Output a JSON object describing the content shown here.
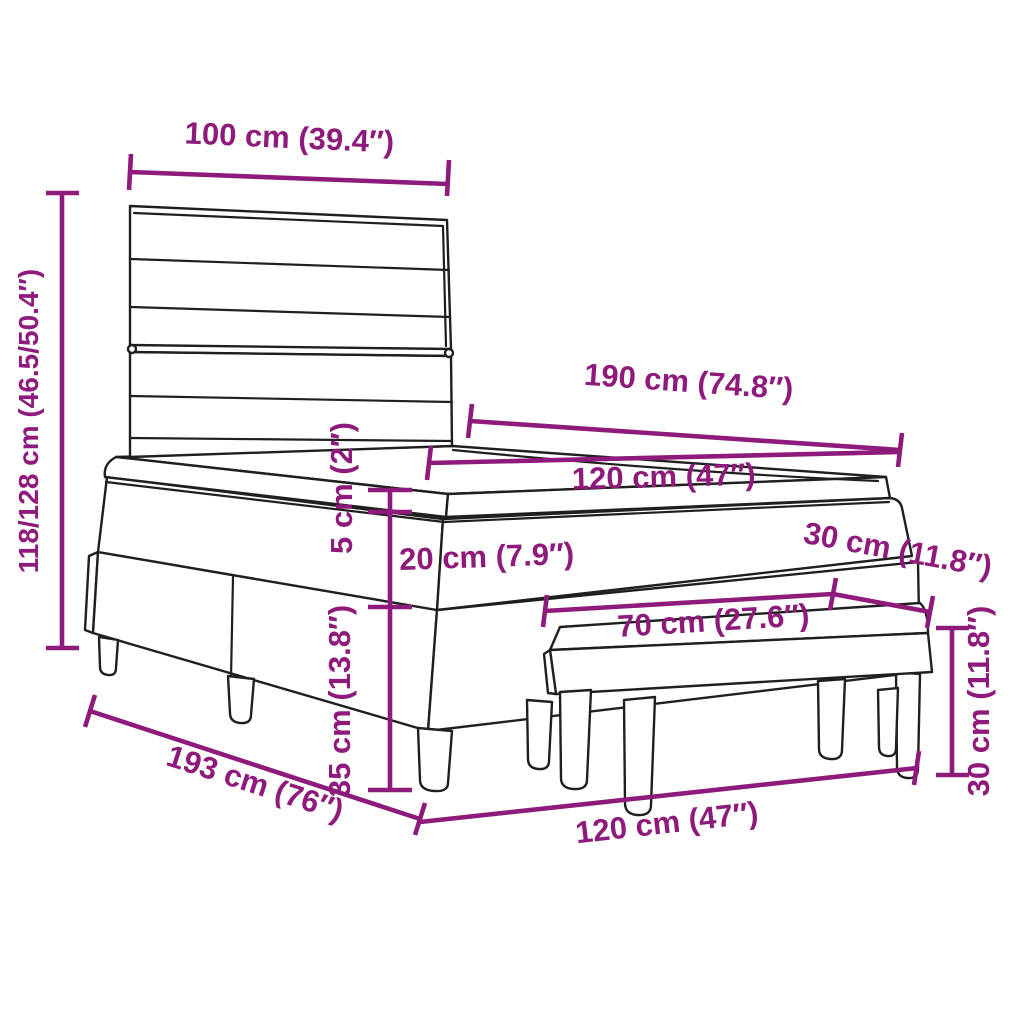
{
  "diagram": {
    "colors": {
      "dimension": "#8E1A7C",
      "outline": "#1F1F1F",
      "background": "#FFFFFF"
    },
    "dimensions": {
      "headboard_width": "100 cm (39.4″)",
      "total_height": "118/128 cm (46.5/50.4″)",
      "bed_length": "190 cm (74.8″)",
      "bed_width_top": "120 cm (47″)",
      "topper_height": "5 cm (2″)",
      "mattress_height": "20 cm (7.9″)",
      "base_height": "35 cm (13.8″)",
      "bench_depth": "30 cm (11.8″)",
      "bench_length": "70 cm (27.6″)",
      "bench_height": "30 cm (11.8″)",
      "floor_length": "193 cm (76″)",
      "floor_width": "120 cm (47″)"
    }
  }
}
